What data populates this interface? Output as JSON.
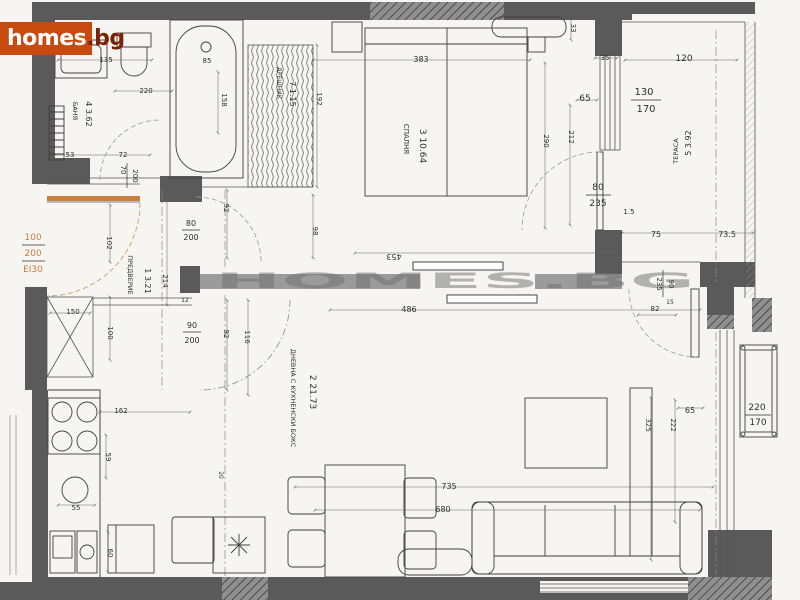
{
  "logo": {
    "primary": "homes",
    "suffix": ".bg"
  },
  "watermark": "HOMES.BG",
  "colors": {
    "logo_bg": "#c94a0e",
    "logo_text": "#ffffff",
    "logo_suffix": "#7c2104",
    "entry_accent": "#c8803c",
    "wall_dark": "#5a5a5a",
    "wall_medium": "#9b9b9b",
    "paper": "#f6f5f2"
  },
  "rooms": [
    {
      "num": "1",
      "name": "ПРЕДВЕРИЕ",
      "area": "3.21",
      "label_xy": [
        128,
        275
      ],
      "num_xy": [
        145,
        281
      ],
      "rot": 90,
      "name_size": 6.5,
      "num_size": 8
    },
    {
      "num": "2",
      "name": "ДНЕВНА С КУХНЕНСКИ БОКС",
      "area": "21.73",
      "label_xy": [
        291,
        398
      ],
      "num_xy": [
        310,
        392
      ],
      "rot": 90,
      "name_size": 6.5,
      "num_size": 9
    },
    {
      "num": "3",
      "name": "СПАЛНЯ",
      "area": "10.64",
      "label_xy": [
        404,
        139
      ],
      "num_xy": [
        420,
        146
      ],
      "rot": 90,
      "name_size": 7,
      "num_size": 9
    },
    {
      "num": "4",
      "name": "БАНЯ",
      "area": "3.62",
      "label_xy": [
        73,
        111
      ],
      "num_xy": [
        86,
        114
      ],
      "rot": 90,
      "name_size": 6.5,
      "num_size": 8
    },
    {
      "num": "5",
      "name": "ТЕРАСА",
      "area": "3.92",
      "label_xy": [
        678,
        151
      ],
      "num_xy": [
        691,
        143
      ],
      "rot": -90,
      "name_size": 6.5,
      "num_size": 8
    },
    {
      "num": "7",
      "name": "ДРЕШНИК",
      "area": "1.15",
      "label_xy": [
        277,
        83
      ],
      "num_xy": [
        290,
        94
      ],
      "rot": 90,
      "name_size": 6,
      "num_size": 8
    }
  ],
  "dimension_labels": [
    {
      "t": "135",
      "x": 106,
      "y": 62,
      "r": 0,
      "s": 7
    },
    {
      "t": "220",
      "x": 146,
      "y": 93,
      "r": 0,
      "s": 7
    },
    {
      "t": "53",
      "x": 70,
      "y": 157,
      "r": 0,
      "s": 7
    },
    {
      "t": "72",
      "x": 123,
      "y": 157,
      "r": 0,
      "s": 7
    },
    {
      "t": "70",
      "x": 121,
      "y": 170,
      "r": 90,
      "s": 7
    },
    {
      "t": "200",
      "x": 133,
      "y": 176,
      "r": 90,
      "s": 7
    },
    {
      "t": "85",
      "x": 207,
      "y": 63,
      "r": 0,
      "s": 7
    },
    {
      "t": "158",
      "x": 222,
      "y": 100,
      "r": 90,
      "s": 7
    },
    {
      "t": "192",
      "x": 317,
      "y": 99,
      "r": 90,
      "s": 7
    },
    {
      "t": "383",
      "x": 421,
      "y": 62,
      "r": 0,
      "s": 8
    },
    {
      "t": "33",
      "x": 571,
      "y": 28,
      "r": 90,
      "s": 7
    },
    {
      "t": "35",
      "x": 605,
      "y": 60,
      "r": 0,
      "s": 7
    },
    {
      "t": "65",
      "x": 585,
      "y": 101,
      "r": 0,
      "s": 9
    },
    {
      "t": "290",
      "x": 544,
      "y": 141,
      "r": 90,
      "s": 7
    },
    {
      "t": "212",
      "x": 569,
      "y": 137,
      "r": 90,
      "s": 7
    },
    {
      "t": "98",
      "x": 313,
      "y": 231,
      "r": 90,
      "s": 7
    },
    {
      "t": "130",
      "x": 644,
      "y": 95,
      "r": 0,
      "s": 10
    },
    {
      "t": "170",
      "x": 646,
      "y": 112,
      "r": 0,
      "s": 10
    },
    {
      "t": "120",
      "x": 684,
      "y": 61,
      "r": 0,
      "s": 9
    },
    {
      "t": "80",
      "x": 598,
      "y": 190,
      "r": 0,
      "s": 9
    },
    {
      "t": "235",
      "x": 598,
      "y": 206,
      "r": 0,
      "s": 9
    },
    {
      "t": "1.5",
      "x": 629,
      "y": 214,
      "r": 0,
      "s": 7
    },
    {
      "t": "75",
      "x": 656,
      "y": 237,
      "r": 0,
      "s": 8
    },
    {
      "t": "73.5",
      "x": 727,
      "y": 237,
      "r": 0,
      "s": 8
    },
    {
      "t": "92",
      "x": 224,
      "y": 208,
      "r": 90,
      "s": 7
    },
    {
      "t": "80",
      "x": 191,
      "y": 226,
      "r": 0,
      "s": 8
    },
    {
      "t": "200",
      "x": 191,
      "y": 240,
      "r": 0,
      "s": 8
    },
    {
      "t": "102",
      "x": 107,
      "y": 243,
      "r": 90,
      "s": 7
    },
    {
      "t": "214",
      "x": 163,
      "y": 281,
      "r": 90,
      "s": 7
    },
    {
      "t": "100",
      "x": 33,
      "y": 240,
      "r": 0,
      "s": 9,
      "c": "o"
    },
    {
      "t": "200",
      "x": 33,
      "y": 256,
      "r": 0,
      "s": 9,
      "c": "o"
    },
    {
      "t": "ЕI30",
      "x": 33,
      "y": 272,
      "r": 0,
      "s": 9,
      "c": "o"
    },
    {
      "t": "150",
      "x": 73,
      "y": 314,
      "r": 0,
      "s": 7
    },
    {
      "t": "100",
      "x": 108,
      "y": 333,
      "r": 90,
      "s": 7
    },
    {
      "t": "12",
      "x": 185,
      "y": 302,
      "r": 0,
      "s": 6
    },
    {
      "t": "90",
      "x": 192,
      "y": 328,
      "r": 0,
      "s": 8
    },
    {
      "t": "200",
      "x": 192,
      "y": 343,
      "r": 0,
      "s": 8
    },
    {
      "t": "92",
      "x": 224,
      "y": 334,
      "r": 90,
      "s": 7
    },
    {
      "t": "116",
      "x": 245,
      "y": 337,
      "r": 90,
      "s": 7
    },
    {
      "t": "453",
      "x": 394,
      "y": 254,
      "r": 180,
      "s": 8
    },
    {
      "t": "486",
      "x": 409,
      "y": 312,
      "r": 0,
      "s": 8
    },
    {
      "t": "162",
      "x": 121,
      "y": 413,
      "r": 0,
      "s": 7
    },
    {
      "t": "59",
      "x": 106,
      "y": 457,
      "r": 90,
      "s": 7
    },
    {
      "t": "55",
      "x": 76,
      "y": 510,
      "r": 0,
      "s": 7
    },
    {
      "t": "60",
      "x": 108,
      "y": 553,
      "r": 90,
      "s": 7
    },
    {
      "t": "20",
      "x": 219,
      "y": 475,
      "r": 90,
      "s": 6
    },
    {
      "t": "735",
      "x": 449,
      "y": 489,
      "r": 0,
      "s": 8
    },
    {
      "t": "680",
      "x": 443,
      "y": 512,
      "r": 0,
      "s": 8
    },
    {
      "t": "325",
      "x": 646,
      "y": 425,
      "r": 90,
      "s": 7
    },
    {
      "t": "222",
      "x": 671,
      "y": 425,
      "r": 90,
      "s": 7
    },
    {
      "t": "65",
      "x": 690,
      "y": 413,
      "r": 0,
      "s": 8
    },
    {
      "t": "220",
      "x": 757,
      "y": 410,
      "r": 0,
      "s": 9
    },
    {
      "t": "170",
      "x": 758,
      "y": 425,
      "r": 0,
      "s": 9
    },
    {
      "t": "90",
      "x": 669,
      "y": 284,
      "r": 90,
      "s": 7
    },
    {
      "t": "235",
      "x": 657,
      "y": 284,
      "r": 90,
      "s": 7
    },
    {
      "t": "82",
      "x": 655,
      "y": 311,
      "r": 0,
      "s": 7
    },
    {
      "t": "15",
      "x": 670,
      "y": 304,
      "r": 0,
      "s": 6
    }
  ]
}
